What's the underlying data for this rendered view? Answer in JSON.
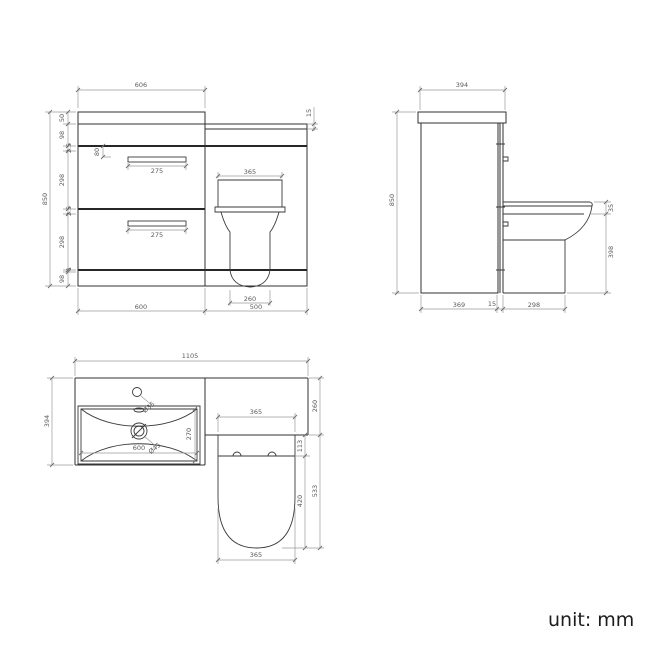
{
  "unit_label": "unit: mm",
  "front": {
    "counter_width": "606",
    "counter_thickness_right": "15",
    "counter_height": "50",
    "top_panel": "98",
    "gap_top": "2.5",
    "drawer1_height": "298",
    "gap_mid": "2.5",
    "drawer2_height": "298",
    "gap_bottom": "1",
    "plinth_height": "98",
    "total_height": "850",
    "handle_offset": "80",
    "handle1_width": "275",
    "handle2_width": "275",
    "cistern_width": "365",
    "pan_base_width": "260",
    "vanity_width": "600",
    "wc_unit_width": "500"
  },
  "side": {
    "depth": "394",
    "total_height": "850",
    "seat_height": "35",
    "pan_height": "398",
    "cabinet_depth": "369",
    "back_panel": "15",
    "pan_projection": "298"
  },
  "plan": {
    "total_width": "1105",
    "cabinet_depth": "394",
    "basin_width": "600",
    "basin_depth": "270",
    "tap_hole_diameter": "Ø35",
    "waste_diameter": "Ø45",
    "seat_width": "365",
    "hinge_inset": "113",
    "seat_inner_length": "420",
    "seat_length": "533",
    "cistern_top_depth": "260",
    "seat_width_bottom": "365"
  }
}
